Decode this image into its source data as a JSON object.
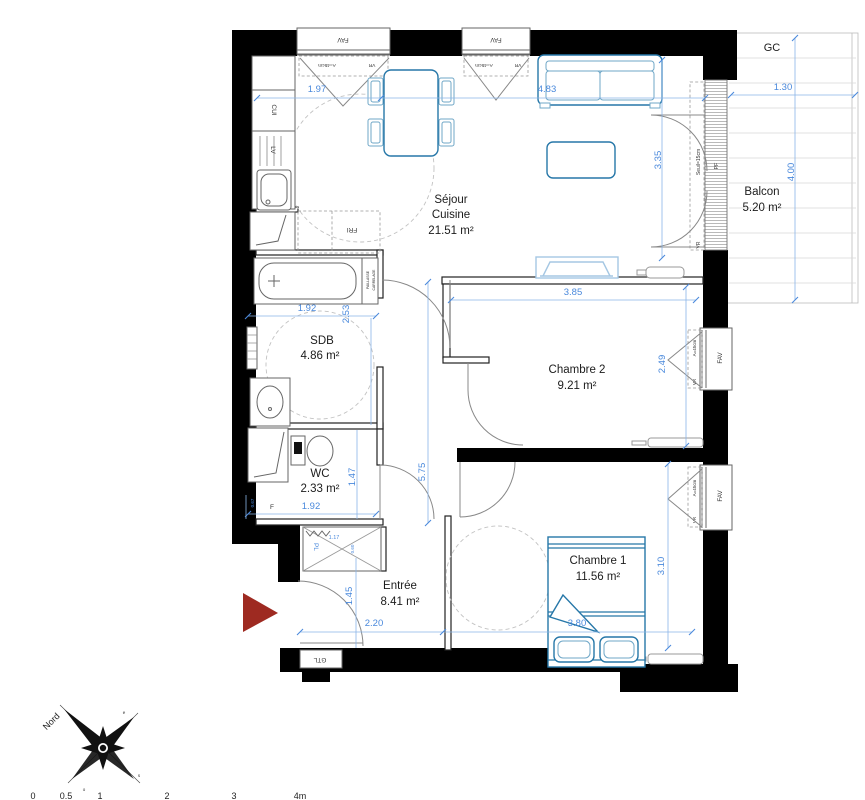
{
  "rooms": {
    "sejour": {
      "line1": "Séjour",
      "line2": "Cuisine",
      "area": "21.51 m²"
    },
    "sdb": {
      "name": "SDB",
      "area": "4.86 m²"
    },
    "wc": {
      "name": "WC",
      "area": "2.33 m²"
    },
    "entree": {
      "name": "Entrée",
      "area": "8.41 m²"
    },
    "chambre1": {
      "name": "Chambre 1",
      "area": "11.56 m²"
    },
    "chambre2": {
      "name": "Chambre 2",
      "area": "9.21 m²"
    },
    "balcon": {
      "name": "Balcon",
      "area": "5.20 m²"
    }
  },
  "dimensions": {
    "kitchen_width": "1.97",
    "sejour_width": "4.83",
    "balcony_width": "1.30",
    "balcony_height": "4.00",
    "sejour_height": "3.35",
    "chambre2_width": "3.85",
    "chambre2_height": "2.49",
    "sdb_width": "1.92",
    "sdb_height": "2.53",
    "hall_height": "5.75",
    "wc_height": "1.47",
    "wc_width": "1.92",
    "wc_offset": "0.67",
    "closet_width": "1.17",
    "closet_depth": "0.60",
    "entree_height": "1.45",
    "entree_width": "2.20",
    "chambre1_height": "3.10",
    "chambre1_width": "3.80"
  },
  "labels": {
    "gc": "GC",
    "fav": "FAV",
    "vr": "VR",
    "shutter_height": "A=45cm",
    "seuil": "Seuil=15cm",
    "pf": "PF",
    "cui": "CUI",
    "lv": "LV",
    "fri": "FRI",
    "paillasse": "PAILLASSE",
    "carrelage": "CARRELAGE",
    "pl": "PL",
    "f": "F",
    "gtl": "GTL"
  },
  "compass": {
    "north": "Nord",
    "east": "e",
    "south": "s",
    "west": "o"
  },
  "scale_bar": {
    "t0": "0",
    "t05": "0.5",
    "t1": "1",
    "t2": "2",
    "t3": "3",
    "t4": "4m"
  },
  "colors": {
    "wall": "#000000",
    "dimension": "#4a89dc",
    "furniture": "#2677a8",
    "radiator": "#a5c7e3",
    "entry_arrow": "#9e2a21"
  }
}
